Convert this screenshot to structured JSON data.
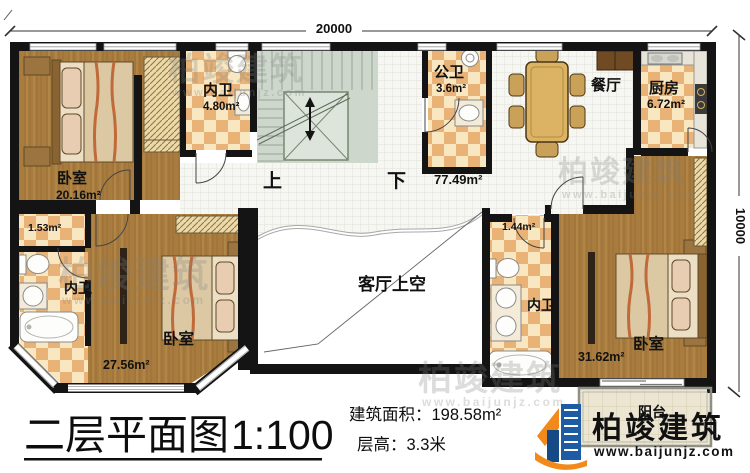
{
  "dimensions": {
    "top_width": "20000",
    "right_height": "10000"
  },
  "rooms": {
    "bedroom_tl": {
      "label": "卧室",
      "area": "20.16m²"
    },
    "bath_tl": {
      "label": "内卫",
      "area": "4.80m²"
    },
    "stairs": {
      "up": "上",
      "down": "下"
    },
    "public_bath": {
      "label": "公卫",
      "area": "3.6m²"
    },
    "dining": {
      "label": "餐厅"
    },
    "kitchen": {
      "label": "厨房",
      "area": "6.72m²"
    },
    "hall": {
      "area": "77.49m²"
    },
    "closet_bl": {
      "area": "1.53m²"
    },
    "bath_bl": {
      "label": "内卫"
    },
    "bedroom_bl": {
      "label": "卧室",
      "area": "27.56m²"
    },
    "living_void": {
      "label": "客厅上空"
    },
    "closet_br": {
      "area": "1.44m²"
    },
    "bath_br": {
      "label": "内卫"
    },
    "bedroom_br": {
      "label": "卧室",
      "area": "31.62m²"
    },
    "balcony": {
      "label": "阳台"
    }
  },
  "footer": {
    "plan_title": "二层平面图",
    "plan_scale": "1:100",
    "area_label": "建筑面积：",
    "area_value": "198.58m²",
    "height_label": "层高：",
    "height_value": "3.3米"
  },
  "brand": {
    "name": "柏竣建筑",
    "website": "www.baijunjz.com"
  },
  "watermark": {
    "text": "柏竣建筑",
    "site": "www.baijunjz.com"
  },
  "colors": {
    "wall": "#141414",
    "wood": "#a87c3e",
    "checker_light": "#f8e7c0",
    "checker_dark": "#e9b377",
    "tile": "#f6f6f3",
    "stair": "#cdd7cc",
    "balcony": "#ebe5d2",
    "logo_blue": "#1d5ca5",
    "logo_orange": "#f28a1b"
  }
}
